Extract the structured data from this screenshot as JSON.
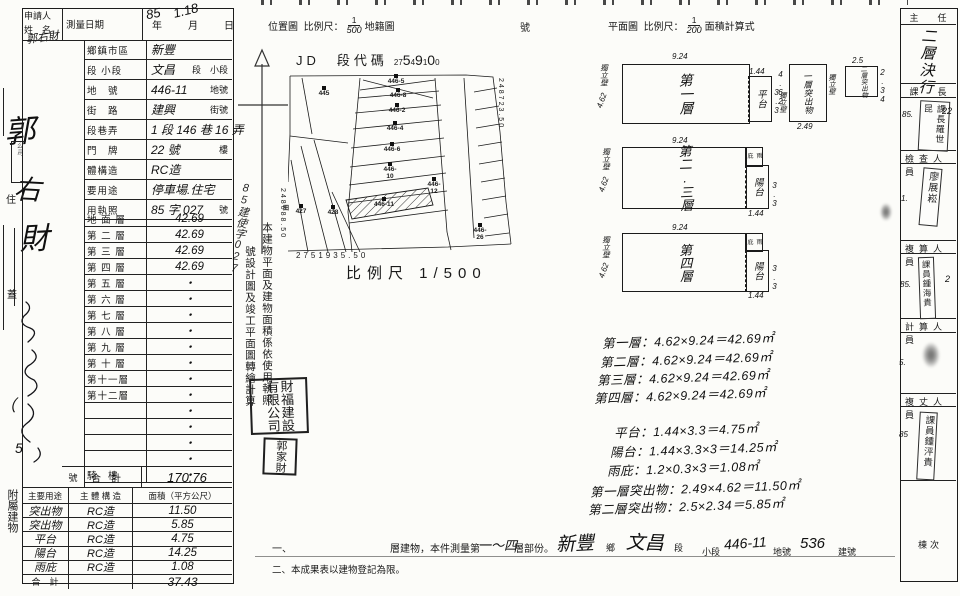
{
  "page": {
    "title_note": "建物測量成果圖(掃描文件)"
  },
  "left_margin": {
    "applicant_label": "申請人",
    "name_label": "姓　名",
    "name_small": "郭右財",
    "name_big": [
      "郭",
      "右",
      "財"
    ],
    "company_mark": "公司",
    "seal_label": "蓋",
    "address_label": "住",
    "paren_mark": "（",
    "five_mark": "5",
    "attach_label": "附屬建物"
  },
  "form": {
    "survey_date_label": "測量日期",
    "survey_date_hw_year": "85",
    "survey_date_hw_md": "1.18",
    "date_units": "年　　月　　日",
    "rows": [
      {
        "label": "鄉鎮市區",
        "value": "新豐",
        "suffix": ""
      },
      {
        "label": "段 小段",
        "value": "文昌",
        "suffix": "段　小段"
      },
      {
        "label": "地　號",
        "value": "446-11",
        "suffix": "地號"
      },
      {
        "label": "街　路",
        "value": "建興",
        "suffix": "街號"
      },
      {
        "label": "段巷弄",
        "value": "1 段 146 巷 16 弄",
        "suffix": ""
      },
      {
        "label": "門　牌",
        "value": "22 號",
        "suffix": "樓"
      },
      {
        "label": "體構造",
        "value": "RC造",
        "suffix": ""
      },
      {
        "label": "要用途",
        "value": "停車場.住宅",
        "suffix": ""
      },
      {
        "label": "用執照",
        "value": "85 字 027",
        "suffix": "號"
      }
    ],
    "floor_rows": [
      {
        "label": "地 面 層",
        "value": "42.69"
      },
      {
        "label": "第 二 層",
        "value": "42.69"
      },
      {
        "label": "第 三 層",
        "value": "42.69"
      },
      {
        "label": "第 四 層",
        "value": "42.69"
      },
      {
        "label": "第 五 層",
        "value": "・"
      },
      {
        "label": "第 六 層",
        "value": "・"
      },
      {
        "label": "第 七 層",
        "value": "・"
      },
      {
        "label": "第 八 層",
        "value": "・"
      },
      {
        "label": "第 九 層",
        "value": "・"
      },
      {
        "label": "第 十 層",
        "value": "・"
      },
      {
        "label": "第十一層",
        "value": "・"
      },
      {
        "label": "第十二層",
        "value": "・"
      },
      {
        "label": "",
        "value": "・"
      },
      {
        "label": "",
        "value": "・"
      },
      {
        "label": "",
        "value": "・"
      },
      {
        "label": "",
        "value": "・"
      },
      {
        "label": "騎　樓",
        "value": "・"
      }
    ],
    "total_prefix": "號",
    "total_label": "合　計",
    "total_value": "170.76"
  },
  "summary": {
    "headers": [
      "主要用途",
      "主 體 構 造",
      "面積（平方公尺）"
    ],
    "rows": [
      {
        "use": "突出物",
        "structure": "RC造",
        "area": "11.50"
      },
      {
        "use": "突出物",
        "structure": "RC造",
        "area": "5.85"
      },
      {
        "use": "平台",
        "structure": "RC造",
        "area": "4.75"
      },
      {
        "use": "陽台",
        "structure": "RC造",
        "area": "14.25"
      },
      {
        "use": "雨庇",
        "structure": "RC造",
        "area": "1.08"
      }
    ],
    "total_label": "合　計",
    "total_value": "37.43"
  },
  "location": {
    "header_title": "位置圖",
    "scale_label": "比例尺：",
    "scale_num": "1",
    "scale_den": "500",
    "map_type_label": "地籍圖",
    "number_suffix": "號",
    "section_code_prefix": "JD　段代碼",
    "section_code_digits": [
      {
        "t": "27",
        "s": 1
      },
      {
        "t": "5"
      },
      {
        "t": "4",
        "s": 1
      },
      {
        "t": "9"
      },
      {
        "t": "1",
        "s": 1
      },
      {
        "t": "0"
      },
      {
        "t": "0",
        "s": 1
      }
    ],
    "coord_right": "248723.50",
    "coord_left": "248688.50",
    "coord_bottom": "2751935.50",
    "scale_caption": "比例尺 1/500",
    "parcels": [
      {
        "t": "445",
        "x": 314,
        "y": 86,
        "f": ""
      },
      {
        "t": "446-5",
        "x": 386,
        "y": 74,
        "f": ""
      },
      {
        "t": "446-8",
        "x": 388,
        "y": 88,
        "f": ""
      },
      {
        "t": "446-2",
        "x": 387,
        "y": 103,
        "f": ""
      },
      {
        "t": "446-4",
        "x": 385,
        "y": 121,
        "f": ""
      },
      {
        "t": "446-6",
        "x": 382,
        "y": 142,
        "f": ""
      },
      {
        "t": "446-10",
        "x": 380,
        "y": 162,
        "f": ""
      },
      {
        "t": "446-11",
        "x": 374,
        "y": 197,
        "f": ""
      },
      {
        "t": "446-12",
        "x": 424,
        "y": 177,
        "f": ""
      },
      {
        "t": "446-26",
        "x": 470,
        "y": 223,
        "f": ""
      },
      {
        "t": "427",
        "x": 291,
        "y": 204,
        "f": "田"
      },
      {
        "t": "428",
        "x": 323,
        "y": 205,
        "f": ""
      }
    ]
  },
  "note_vertical": {
    "col1": "本建物平面及建物面積係依使用執照",
    "col2": "號設計圖及竣工平面圖轉繪計算",
    "hw_insert": "85建使字027"
  },
  "stamps": {
    "company": "財福建設有限公司",
    "person": "郭家財"
  },
  "plans": {
    "header_title": "平面圖",
    "scale_label": "比例尺：",
    "scale_num": "1",
    "scale_den": "200",
    "calc_label": "面積計算式",
    "wall_label": "獨立壁",
    "row1": {
      "main": "第一層",
      "dim_top": "9.24",
      "dim_left": "4.62",
      "attach": "平台",
      "attach_top": "1.44",
      "attach_right": "3.3",
      "p1": "一層突出物",
      "p1_left": "4.62",
      "p1_bottom": "2.49",
      "p2": "二層突出物",
      "p2_top": "2.5",
      "p2_right": "2.34"
    },
    "row2": {
      "main": "第二.三層",
      "dim_top": "9.24",
      "dim_left": "4.62",
      "eave": "雨庇",
      "balcony": "陽台",
      "b_right": "3.3",
      "b_bottom": "1.44"
    },
    "row3": {
      "main": "第四層",
      "dim_top": "9.24",
      "dim_left": "4.62",
      "eave": "雨庇",
      "balcony": "陽台",
      "b_right": "3.3",
      "b_bottom": "1.44"
    }
  },
  "calculations": [
    {
      "t": "第一層：4.62×9.24＝42.69㎡",
      "x": 602,
      "y": 330
    },
    {
      "t": "第二層：4.62×9.24＝42.69㎡",
      "x": 600,
      "y": 349
    },
    {
      "t": "第三層：4.62×9.24＝42.69㎡",
      "x": 597,
      "y": 367
    },
    {
      "t": "第四層：4.62×9.24＝42.69㎡",
      "x": 594,
      "y": 385
    },
    {
      "t": "平台：1.44×3.3＝4.75㎡",
      "x": 614,
      "y": 420
    },
    {
      "t": "陽台：1.44×3.3×3＝14.25㎡",
      "x": 610,
      "y": 439
    },
    {
      "t": "雨庇：1.2×0.3×3＝1.08㎡",
      "x": 607,
      "y": 458
    },
    {
      "t": "第一層突出物：2.49×4.62＝11.50㎡",
      "x": 590,
      "y": 478
    },
    {
      "t": "第二層突出物：2.5×2.34＝5.85㎡",
      "x": 588,
      "y": 496
    }
  ],
  "footnotes": {
    "n1_prefix": "一、",
    "n1_a": "層建物，本件測量第",
    "n1_hw1": "一～四",
    "n1_b": "層部份。",
    "n1_hw2": "新豐",
    "n1_c": "鄉",
    "n1_hw3": "文昌",
    "n1_d": "段",
    "n1_e": "小段",
    "n1_hw4": "446-11",
    "n1_f": "地號",
    "n1_hw5": "536",
    "n1_g": "建號",
    "n2": "二、本成果表以建物登記為限。"
  },
  "approvals": {
    "sections": [
      {
        "title": "主　任",
        "hw": "二層決行"
      },
      {
        "title": "課　長",
        "stamp": "課長羅世昆",
        "date_l": "85.",
        "date_r": "22"
      },
      {
        "title": "檢查人員",
        "stamp": "廖展崧",
        "date_l": "1."
      },
      {
        "title": "複算人員",
        "stamp": "課員鍾海貴",
        "date_l": "85.",
        "date_r": "2"
      },
      {
        "title": "計算人員",
        "date_l": "5."
      },
      {
        "title": "複丈人員",
        "stamp": "課員鍾泙貴",
        "date_l": "85"
      }
    ],
    "unit_label": "棟次"
  }
}
